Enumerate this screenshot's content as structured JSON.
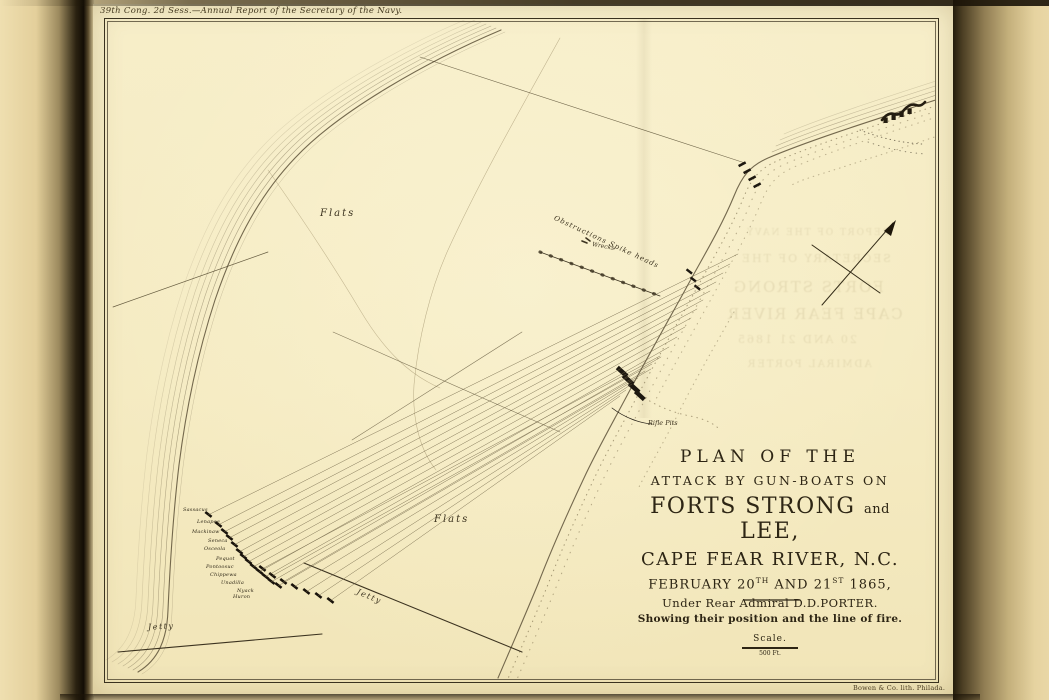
{
  "scan": {
    "header_annotation": "39th Cong. 2d Sess.—Annual Report of the Secretary of the Navy.",
    "imprint": "Bowen & Co. lith. Philada."
  },
  "title_block": {
    "line1": "PLAN OF THE",
    "line2": "ATTACK BY GUN-BOATS ON",
    "line3_a": "FORTS STRONG ",
    "line3_and": "and",
    "line3_b": " LEE,",
    "line4": "CAPE FEAR RIVER, N.C.",
    "line5_a": "FEBRUARY 20",
    "line5_sup1": "TH",
    "line5_b": " AND 21",
    "line5_sup2": "ST",
    "line5_c": " 1865,",
    "line6": "Under Rear Admiral D.D.PORTER.",
    "line7": "Showing their position and the line of fire.",
    "scale_label": "Scale.",
    "scale_value": "500 Ft."
  },
  "map_labels": {
    "flats_upper": "Flats",
    "flats_lower": "Flats",
    "jetty_sw": "Jetty",
    "jetty_mid": "Jetty",
    "obstructions": "Obstructions   Spike heads",
    "wrecks": "Wrecks",
    "rifle_pits": "Rifle Pits"
  },
  "gunboats": [
    {
      "name": "Sassacus"
    },
    {
      "name": "Lenapee"
    },
    {
      "name": "Mackinaw"
    },
    {
      "name": "Seneca"
    },
    {
      "name": "Osceola"
    },
    {
      "name": "Pequot"
    },
    {
      "name": "Pontoosuc"
    },
    {
      "name": "Chippewa"
    },
    {
      "name": "Unadilla"
    },
    {
      "name": "Nyack"
    },
    {
      "name": "Huron"
    }
  ],
  "bleed_through": [
    "REPORT OF THE NAVY",
    "SECRETARY OF THE",
    "FORTS STRONG",
    "CAPE FEAR RIVER",
    "20 AND 21 1865",
    "ADMIRAL PORTER"
  ],
  "colors": {
    "paper": "#f6ecc6",
    "margin": "#e9d7a6",
    "ink": "#33291a",
    "water_line": "#8d7c55",
    "accent_dark": "#1c150b"
  }
}
